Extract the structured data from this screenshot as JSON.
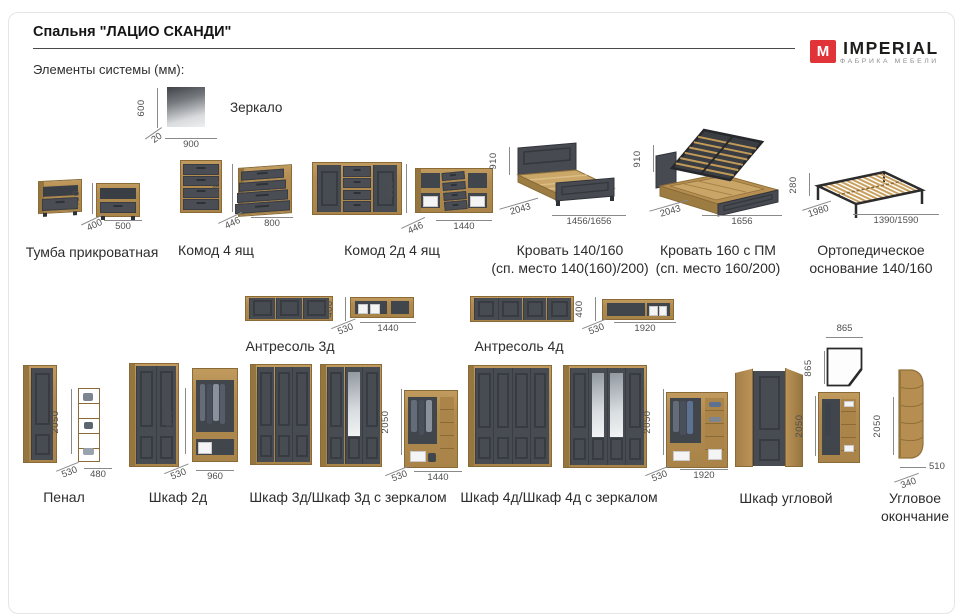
{
  "header": {
    "title": "Спальня \"ЛАЦИО СКАНДИ\"",
    "subtitle": "Элементы системы (мм):"
  },
  "logo": {
    "mark": "M",
    "brand": "IMPERIAL",
    "tagline": "ФАБРИКА МЕБЕЛИ",
    "accent_color": "#e03438"
  },
  "colors": {
    "wood": "#b18b50",
    "dark_facade": "#474b52"
  },
  "mirror": {
    "label": "Зеркало",
    "h": "600",
    "d": "20",
    "w": "900"
  },
  "items": {
    "tumba": {
      "label": "Тумба прикроватная",
      "h": "430",
      "d": "400",
      "w": "500"
    },
    "komod4": {
      "label": "Комод 4 ящ",
      "h": "830",
      "d": "446",
      "w": "800"
    },
    "komod2d4": {
      "label": "Комод 2д 4 ящ",
      "h": "830",
      "d": "446",
      "w": "1440"
    },
    "bed140": {
      "label": "Кровать 140/160",
      "sub": "(сп. место 140(160)/200)",
      "h": "910",
      "d": "2043",
      "w": "1456/1656"
    },
    "bed160pm": {
      "label": "Кровать 160 с ПМ",
      "sub": "(сп. место 160/200)",
      "h": "910",
      "d": "2043",
      "w": "1656"
    },
    "osnovanie": {
      "label": "Ортопедическое",
      "sub": "основание 140/160",
      "h": "280",
      "d": "1980",
      "w": "1390/1590"
    },
    "antresol3": {
      "label": "Антресоль 3д",
      "h": "400",
      "d": "530",
      "w": "1440"
    },
    "antresol4": {
      "label": "Антресоль 4д",
      "h": "400",
      "d": "530",
      "w": "1920"
    },
    "penal": {
      "label": "Пенал",
      "h": "2050",
      "d": "530",
      "w": "480"
    },
    "shkaf2": {
      "label": "Шкаф 2д",
      "h": "2050",
      "d": "530",
      "w": "960"
    },
    "shkaf3": {
      "label": "Шкаф 3д/Шкаф 3д с зеркалом",
      "h": "2050",
      "d": "530",
      "w": "1440"
    },
    "shkaf4": {
      "label": "Шкаф 4д/Шкаф 4д с зеркалом",
      "h": "2050",
      "d": "530",
      "w": "1920"
    },
    "corner": {
      "label": "Шкаф угловой",
      "h": "2050",
      "pw": "865",
      "pd": "865"
    },
    "uglovoe": {
      "label": "Угловое",
      "sub": "окончание",
      "h": "2050",
      "d": "340",
      "w": "510"
    }
  }
}
